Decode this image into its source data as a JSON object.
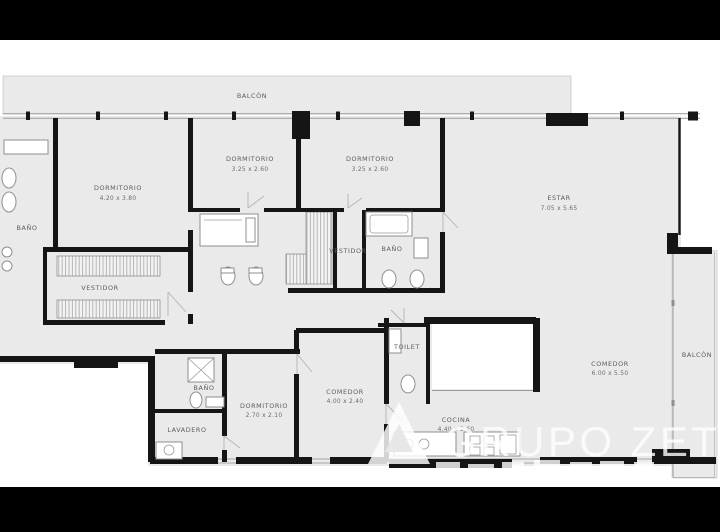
{
  "page": {
    "type": "apartment-floor-plan",
    "letterbox_color": "#000000",
    "background": "#ffffff"
  },
  "palette": {
    "room_fill": "#eaeaea",
    "wall": "#151515",
    "label_text": "#5c5c5c",
    "window_line": "#a5a5a5",
    "watermark": "#ffffff"
  },
  "floorplan": {
    "rooms": [
      {
        "id": "balcon-top",
        "label": "BALCÓN",
        "dims": ""
      },
      {
        "id": "bano-left",
        "label": "BAÑO",
        "dims": ""
      },
      {
        "id": "dormitorio-1",
        "label": "DORMITORIO",
        "dims": "4.20 x 3.80"
      },
      {
        "id": "dormitorio-2",
        "label": "DORMITORIO",
        "dims": "3.25 x 2.60"
      },
      {
        "id": "dormitorio-3",
        "label": "DORMITORIO",
        "dims": "3.25 x 2.60"
      },
      {
        "id": "estar",
        "label": "ESTAR",
        "dims": "7.05 x 5.65"
      },
      {
        "id": "vestidor-main",
        "label": "VESTIDOR",
        "dims": ""
      },
      {
        "id": "vestidor-2",
        "label": "VESTIDOR",
        "dims": ""
      },
      {
        "id": "bano-2",
        "label": "BAÑO",
        "dims": ""
      },
      {
        "id": "toilet",
        "label": "TOILET",
        "dims": ""
      },
      {
        "id": "comedor-right",
        "label": "COMEDOR",
        "dims": "6.00 x 5.50"
      },
      {
        "id": "balcon-right",
        "label": "BALCÓN",
        "dims": ""
      },
      {
        "id": "bano-3",
        "label": "BAÑO",
        "dims": ""
      },
      {
        "id": "lavadero",
        "label": "LAVADERO",
        "dims": ""
      },
      {
        "id": "dormitorio-4",
        "label": "DORMITORIO",
        "dims": "2.70 x 2.10"
      },
      {
        "id": "comedor-center",
        "label": "COMEDOR",
        "dims": "4.00 x 2.40"
      },
      {
        "id": "cocina",
        "label": "COCINA",
        "dims": "4.40 x 2.60"
      }
    ],
    "watermark": {
      "text": "GRUPO ZETA"
    }
  }
}
